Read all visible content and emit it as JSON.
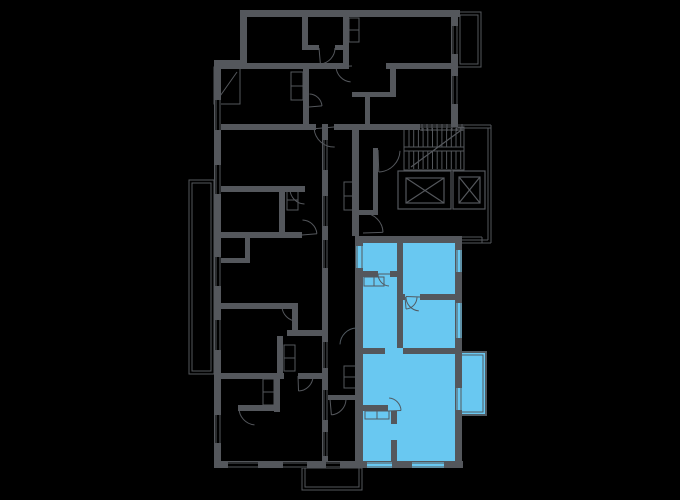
{
  "meta": {
    "view": "building-floor-plan",
    "canvas_width": 680,
    "canvas_height": 500
  },
  "colors": {
    "background": "#000000",
    "wall": "#54575c",
    "thin_line": "#54575c",
    "unit_fill": "#69c8f1",
    "unit_wall": "#515a61"
  },
  "plan": {
    "walls": [
      [
        240,
        10,
        220,
        7
      ],
      [
        451,
        10,
        7,
        117
      ],
      [
        240,
        10,
        7,
        52
      ],
      [
        214,
        60,
        33,
        7
      ],
      [
        214,
        60,
        7,
        408
      ],
      [
        214,
        461,
        249,
        7
      ],
      [
        322,
        124,
        6,
        337
      ],
      [
        352,
        127,
        7,
        109
      ],
      [
        221,
        63,
        122,
        6
      ],
      [
        386,
        63,
        69,
        6
      ],
      [
        302,
        45,
        17,
        5
      ],
      [
        335,
        45,
        10,
        5
      ],
      [
        343,
        17,
        6,
        52
      ],
      [
        302,
        17,
        6,
        33
      ],
      [
        303,
        69,
        6,
        55
      ],
      [
        352,
        92,
        38,
        5
      ],
      [
        365,
        92,
        5,
        32
      ],
      [
        390,
        63,
        6,
        34
      ],
      [
        221,
        124,
        95,
        6
      ],
      [
        334,
        124,
        86,
        6
      ],
      [
        221,
        186,
        84,
        6
      ],
      [
        279,
        186,
        6,
        52
      ],
      [
        221,
        232,
        81,
        6
      ],
      [
        221,
        258,
        29,
        5
      ],
      [
        245,
        238,
        5,
        20
      ],
      [
        221,
        303,
        76,
        6
      ],
      [
        292,
        303,
        6,
        33
      ],
      [
        287,
        330,
        41,
        6
      ],
      [
        277,
        336,
        6,
        37
      ],
      [
        221,
        373,
        63,
        6
      ],
      [
        298,
        373,
        24,
        6
      ],
      [
        274,
        379,
        6,
        33
      ],
      [
        238,
        405,
        38,
        6
      ],
      [
        327,
        395,
        28,
        5
      ],
      [
        373,
        148,
        5,
        67
      ],
      [
        358,
        210,
        17,
        5
      ]
    ],
    "windows": [
      [
        215,
        100,
        6,
        30,
        "k"
      ],
      [
        215,
        165,
        6,
        29,
        "k"
      ],
      [
        215,
        257,
        6,
        29,
        "k"
      ],
      [
        215,
        320,
        6,
        30,
        "k"
      ],
      [
        215,
        415,
        6,
        28,
        "k"
      ],
      [
        228,
        462,
        30,
        6,
        "k"
      ],
      [
        283,
        462,
        24,
        6,
        "k"
      ],
      [
        326,
        462,
        14,
        6,
        "k"
      ],
      [
        323,
        140,
        5,
        30,
        "k"
      ],
      [
        323,
        196,
        5,
        30,
        "k"
      ],
      [
        323,
        240,
        5,
        28,
        "k"
      ],
      [
        323,
        342,
        5,
        26,
        "k"
      ],
      [
        323,
        390,
        5,
        30,
        "k"
      ],
      [
        323,
        432,
        5,
        24,
        "k"
      ],
      [
        452,
        26,
        6,
        28,
        "k"
      ],
      [
        452,
        76,
        6,
        28,
        "k"
      ]
    ],
    "doors": [
      [
        319,
        48,
        16,
        0,
        85
      ],
      [
        352,
        66,
        16,
        95,
        178
      ],
      [
        334,
        127,
        20,
        88,
        175
      ],
      [
        378,
        150,
        22,
        2,
        88
      ],
      [
        363,
        233,
        20,
        272,
        358
      ],
      [
        305,
        189,
        15,
        92,
        178
      ],
      [
        302,
        235,
        15,
        272,
        355
      ],
      [
        297,
        306,
        15,
        92,
        178
      ],
      [
        298,
        376,
        15,
        2,
        88
      ],
      [
        256,
        408,
        17,
        95,
        180
      ],
      [
        330,
        399,
        16,
        2,
        85
      ],
      [
        309,
        107,
        13,
        272,
        355
      ]
    ],
    "closets": [
      [
        349,
        18,
        10,
        12
      ],
      [
        349,
        30,
        10,
        12
      ],
      [
        291,
        72,
        12,
        14
      ],
      [
        291,
        86,
        12,
        14
      ],
      [
        287,
        190,
        11,
        10
      ],
      [
        287,
        200,
        11,
        10
      ],
      [
        284,
        345,
        11,
        13
      ],
      [
        284,
        358,
        11,
        13
      ],
      [
        263,
        379,
        11,
        13
      ],
      [
        263,
        392,
        11,
        13
      ],
      [
        344,
        182,
        12,
        14
      ],
      [
        344,
        196,
        12,
        14
      ],
      [
        344,
        366,
        12,
        11
      ],
      [
        344,
        377,
        12,
        11
      ]
    ],
    "thin_lines": [
      [
        458,
        125,
        491,
        125
      ],
      [
        458,
        128,
        491,
        128
      ],
      [
        488,
        128,
        488,
        240
      ],
      [
        491,
        125,
        491,
        243
      ],
      [
        461,
        240,
        488,
        240
      ],
      [
        458,
        243,
        491,
        243
      ],
      [
        420,
        125,
        464,
        125
      ],
      [
        420,
        130,
        464,
        130
      ],
      [
        462,
        237,
        482,
        237
      ],
      [
        482,
        237,
        482,
        243
      ]
    ],
    "stairs": {
      "box": [
        404,
        127,
        60,
        43
      ],
      "tread_x0": 409,
      "tread_x1": 461,
      "step": 4.7,
      "upper_flight": [
        128,
        147
      ],
      "lower_flight": [
        151,
        169
      ],
      "landing_lines": [
        147,
        151
      ],
      "diagonal": [
        411,
        167,
        460,
        131
      ],
      "window_ticks": {
        "x0": 422,
        "x1": 462,
        "step": 5,
        "y0": 124,
        "y1": 131
      }
    },
    "elevators": [
      {
        "name": "elevator-1",
        "outer": [
          398,
          171,
          53,
          38
        ],
        "inner": [
          406,
          178,
          38,
          25
        ]
      },
      {
        "name": "elevator-2",
        "outer": [
          453,
          171,
          32,
          38
        ],
        "inner": [
          459,
          177,
          21,
          26
        ]
      }
    ],
    "balconies": [
      {
        "name": "balcony-top-right",
        "outer": [
          457,
          12,
          24,
          55
        ],
        "inner": [
          460,
          15,
          18,
          49
        ]
      },
      {
        "name": "balcony-left",
        "outer": [
          189,
          180,
          25,
          194
        ],
        "inner": [
          192,
          183,
          19,
          188
        ]
      },
      {
        "name": "balcony-bottom",
        "outer": [
          302,
          468,
          60,
          22
        ],
        "inner": [
          305,
          468,
          54,
          19
        ]
      },
      {
        "name": "balcony-top-left",
        "outer": [
          214,
          67,
          26,
          37
        ],
        "diagonal": [
          218,
          99,
          237,
          72
        ]
      }
    ]
  },
  "highlighted_unit": {
    "fills": [
      [
        363,
        243,
        92,
        218
      ]
    ],
    "walls": [
      [
        357,
        236,
        105,
        7
      ],
      [
        455,
        236,
        7,
        225
      ],
      [
        355,
        236,
        8,
        225
      ],
      [
        397,
        243,
        6,
        51
      ],
      [
        362,
        271,
        16,
        6
      ],
      [
        390,
        271,
        13,
        6
      ],
      [
        397,
        294,
        8,
        6
      ],
      [
        420,
        294,
        35,
        6
      ],
      [
        397,
        300,
        6,
        48
      ],
      [
        362,
        348,
        23,
        6
      ],
      [
        403,
        348,
        52,
        6
      ],
      [
        362,
        405,
        26,
        6
      ],
      [
        391,
        411,
        6,
        13
      ],
      [
        391,
        440,
        6,
        21
      ]
    ],
    "windows": [
      [
        456,
        250,
        6,
        22,
        "b"
      ],
      [
        456,
        303,
        6,
        35,
        "b"
      ],
      [
        456,
        388,
        6,
        22,
        "b"
      ],
      [
        356,
        246,
        7,
        22,
        "b"
      ],
      [
        367,
        462,
        25,
        6,
        "b"
      ],
      [
        412,
        462,
        32,
        6,
        "b"
      ]
    ],
    "doors": [
      [
        390,
        274,
        12,
        95,
        180
      ],
      [
        420,
        297,
        14,
        95,
        182
      ],
      [
        405,
        297,
        12,
        2,
        85
      ],
      [
        388,
        411,
        13,
        275,
        358
      ],
      [
        357,
        345,
        17,
        182,
        268
      ]
    ],
    "cabinets": [
      [
        364,
        277,
        10,
        9
      ],
      [
        374,
        277,
        10,
        9
      ],
      [
        365,
        411,
        12,
        8
      ],
      [
        377,
        411,
        12,
        8
      ]
    ],
    "balcony": {
      "rect": [
        456,
        352,
        30,
        63
      ],
      "inner": [
        459,
        355,
        24,
        57
      ]
    }
  }
}
